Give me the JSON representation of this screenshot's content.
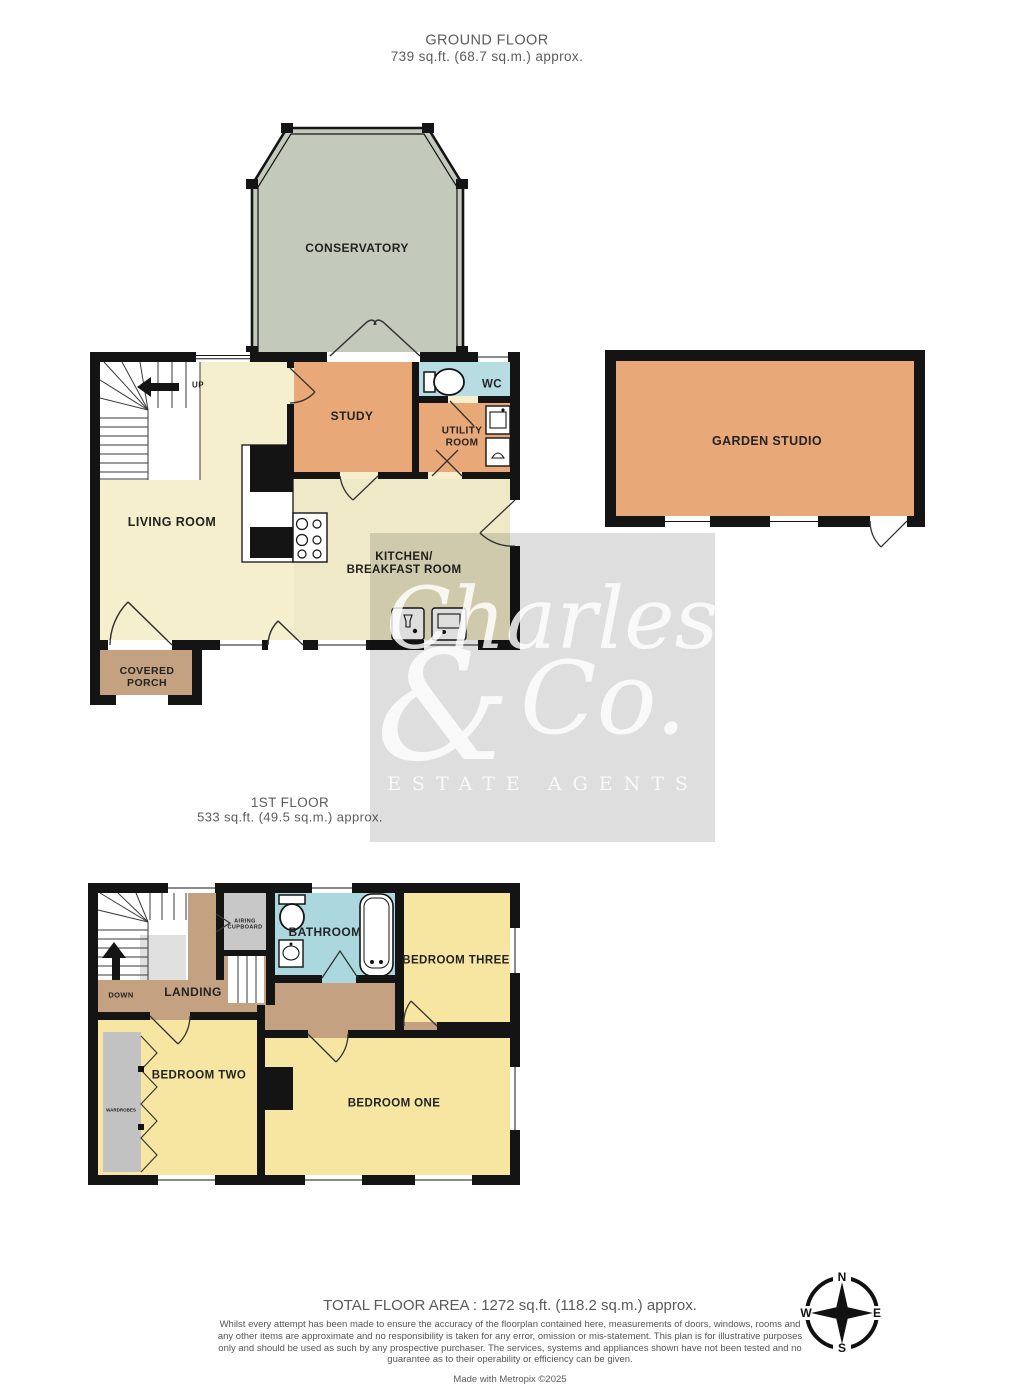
{
  "ground_floor": {
    "title": "GROUND FLOOR",
    "subtitle": "739 sq.ft. (68.7 sq.m.) approx.",
    "rooms": {
      "conservatory": "CONSERVATORY",
      "study": "STUDY",
      "wc": "WC",
      "utility_room": "UTILITY\nROOM",
      "living_room": "LIVING ROOM",
      "kitchen": "KITCHEN/\nBREAKFAST ROOM",
      "covered_porch": "COVERED\nPORCH",
      "garden_studio": "GARDEN STUDIO"
    },
    "stairs_label": "UP"
  },
  "first_floor": {
    "title": "1ST FLOOR",
    "subtitle": "533 sq.ft. (49.5 sq.m.) approx.",
    "rooms": {
      "landing": "LANDING",
      "airing_cupboard": "AIRING\nCUPBOARD",
      "bathroom": "BATHROOM",
      "bedroom_three": "BEDROOM THREE",
      "bedroom_two": "BEDROOM TWO",
      "bedroom_one": "BEDROOM ONE",
      "wardrobes": "WARDROBES"
    },
    "stairs_label": "DOWN"
  },
  "watermark": {
    "word1": "Charles",
    "ampersand": "&",
    "word2": "Co.",
    "tagline": "ESTATE AGENTS"
  },
  "compass": {
    "north": "N",
    "east": "E",
    "south": "S",
    "west": "W"
  },
  "footer": {
    "total_area": "TOTAL FLOOR AREA : 1272 sq.ft. (118.2 sq.m.) approx.",
    "disclaimer": "Whilst every attempt has been made to ensure the accuracy of the floorplan contained here, measurements of doors, windows, rooms and any other items are approximate and no responsibility is taken for any error, omission or mis-statement. This plan is for illustrative purposes only and should be used as such by any prospective purchaser. The services, systems and appliances shown have not been tested and no guarantee as to their operability or efficiency can be given.",
    "credit": "Made with Metropix ©2025"
  },
  "colors": {
    "wall": "#141414",
    "cream": "#f6efcd",
    "kitchen_cream": "#efe9c7",
    "bedroom_yellow": "#f6e6a2",
    "orange": "#e9a877",
    "tan": "#c4a181",
    "bath_blue": "#abd7df",
    "conservatory_green": "#c3cabb",
    "cupboard_grey": "#c8c8c8",
    "watermark_text": "#ffffff"
  }
}
